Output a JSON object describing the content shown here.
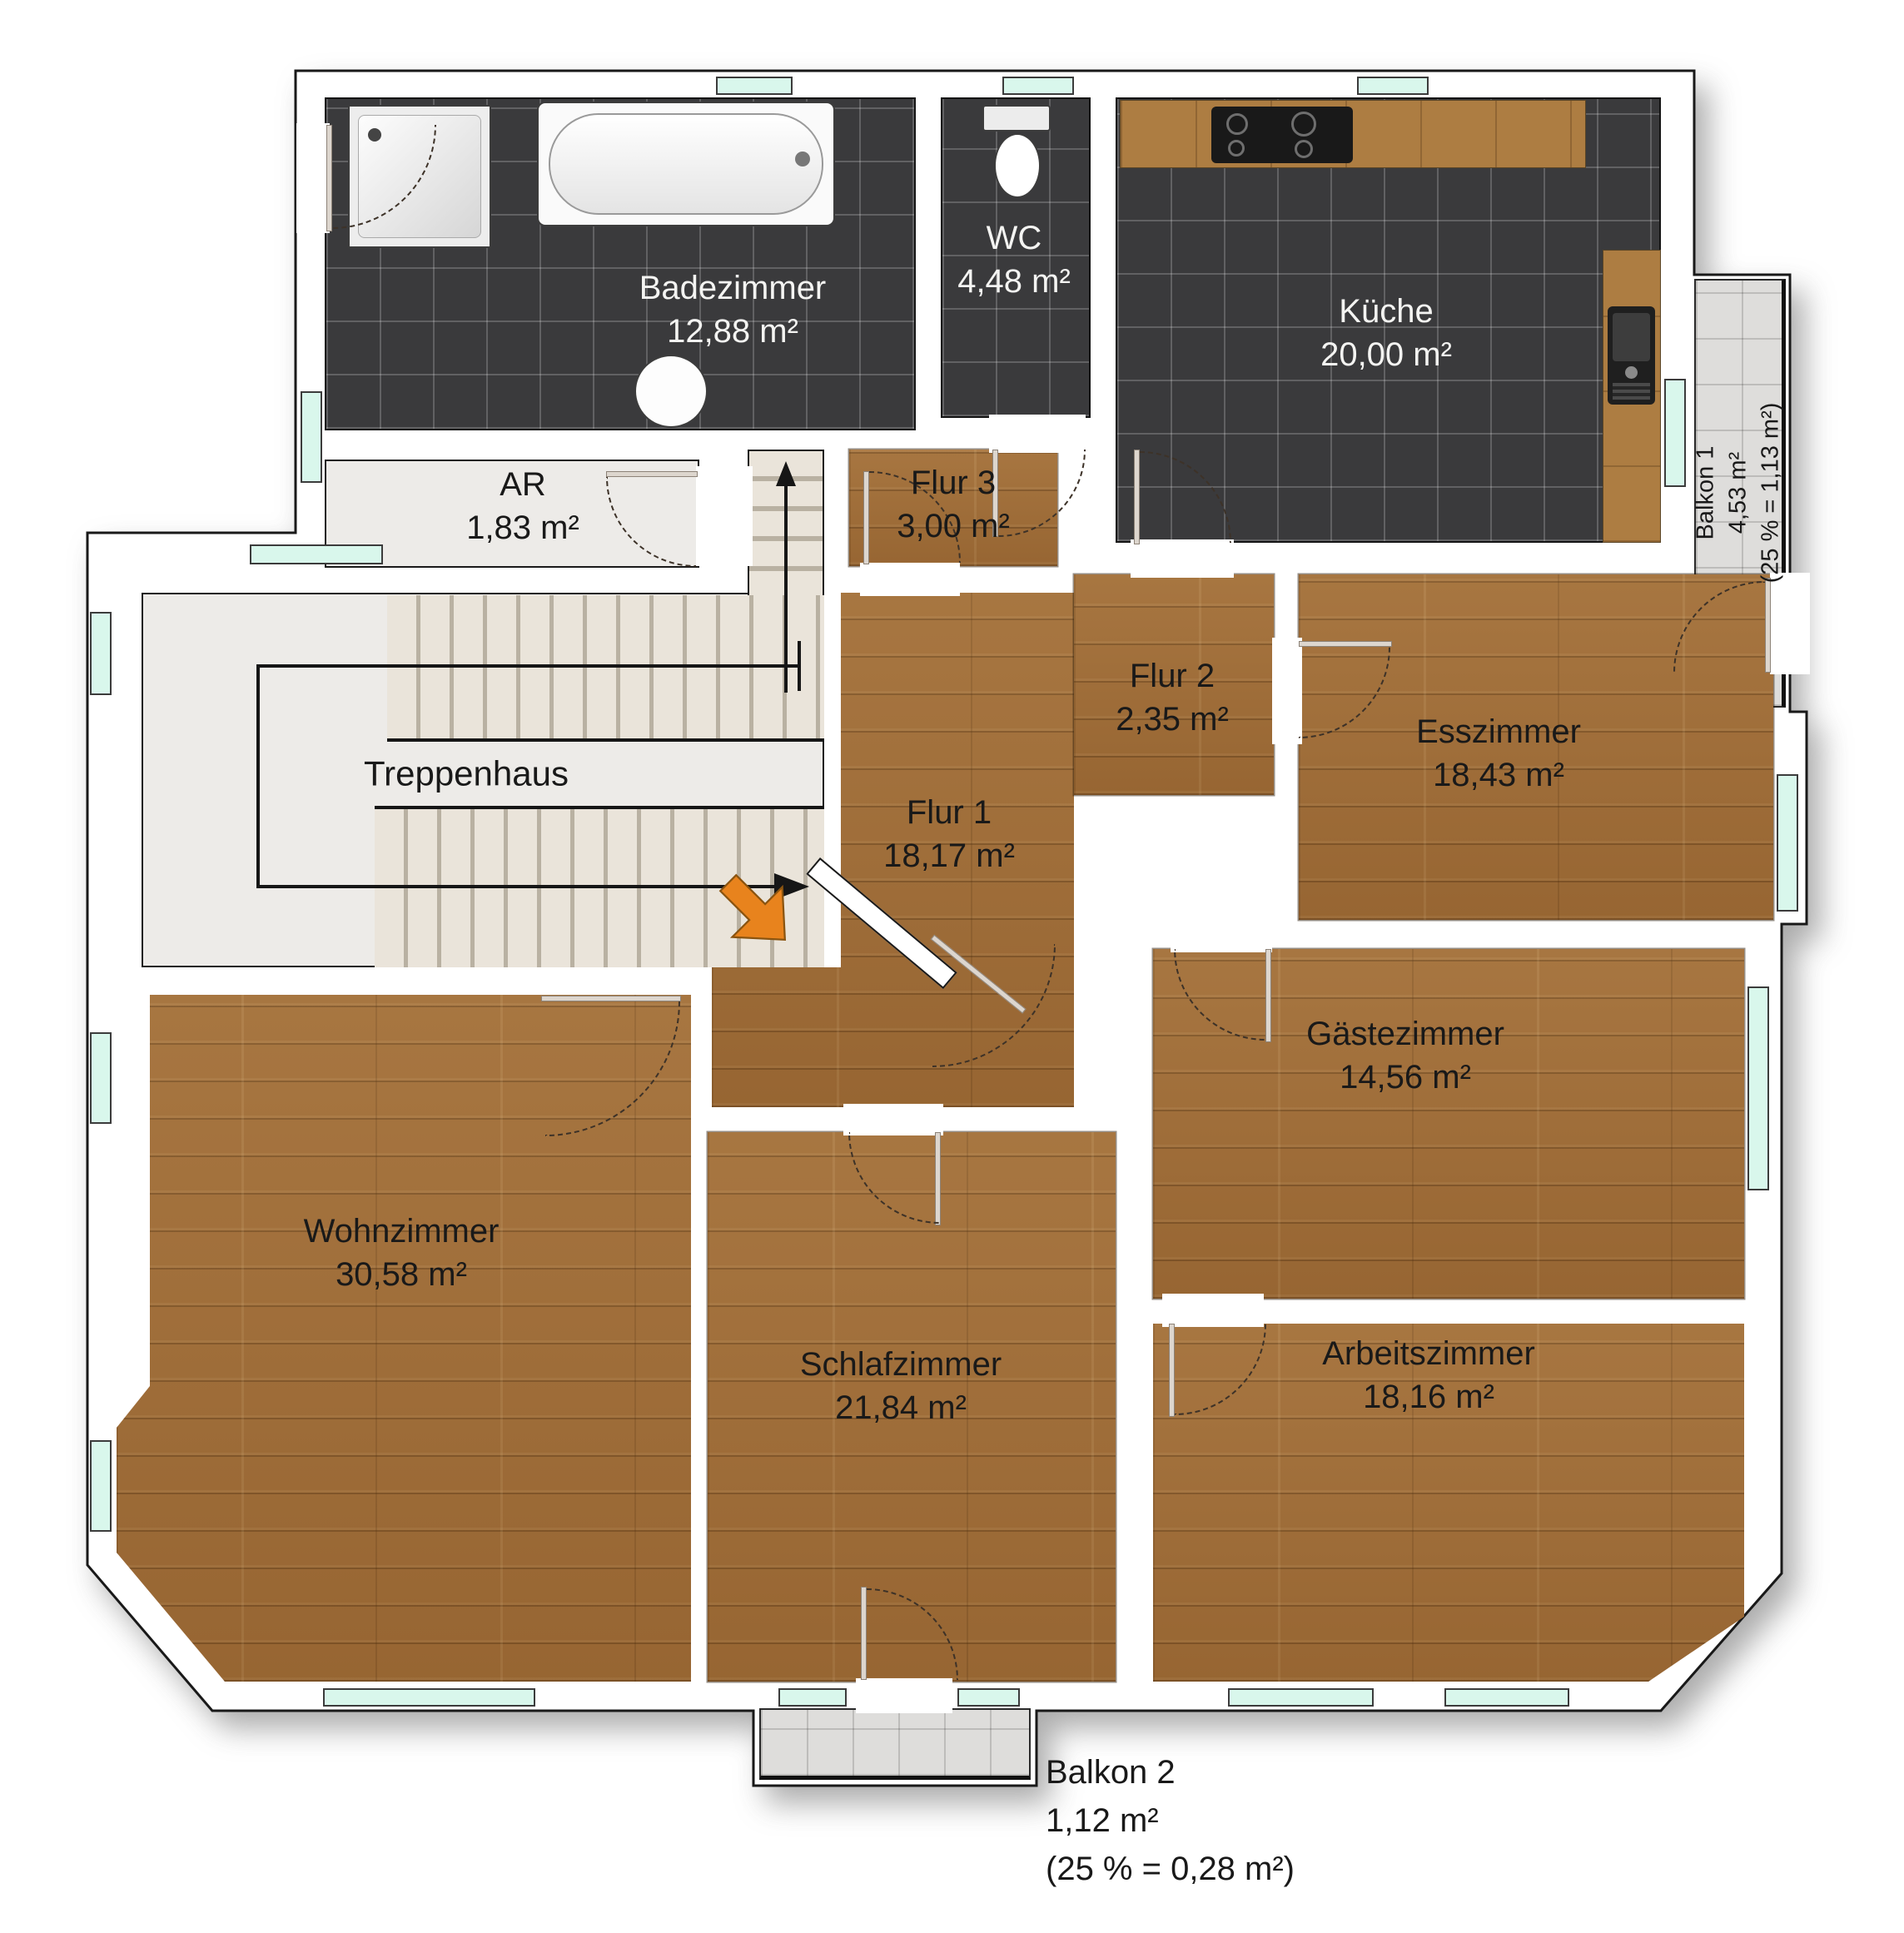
{
  "rooms": {
    "badezimmer": {
      "name": "Badezimmer",
      "area": "12,88 m²"
    },
    "wc": {
      "name": "WC",
      "area": "4,48 m²"
    },
    "kueche": {
      "name": "Küche",
      "area": "20,00 m²"
    },
    "balkon1": {
      "name": "Balkon 1",
      "area": "4,53 m²",
      "note": "(25 % = 1,13 m²)"
    },
    "ar": {
      "name": "AR",
      "area": "1,83 m²"
    },
    "flur3": {
      "name": "Flur 3",
      "area": "3,00 m²"
    },
    "treppenhaus": {
      "name": "Treppenhaus"
    },
    "flur2": {
      "name": "Flur 2",
      "area": "2,35 m²"
    },
    "flur1": {
      "name": "Flur 1",
      "area": "18,17 m²"
    },
    "esszimmer": {
      "name": "Esszimmer",
      "area": "18,43 m²"
    },
    "gaestezimmer": {
      "name": "Gästezimmer",
      "area": "14,56 m²"
    },
    "wohnzimmer": {
      "name": "Wohnzimmer",
      "area": "30,58 m²"
    },
    "schlafzimmer": {
      "name": "Schlafzimmer",
      "area": "21,84 m²"
    },
    "arbeitszimmer": {
      "name": "Arbeitszimmer",
      "area": "18,16 m²"
    },
    "balkon2": {
      "name": "Balkon 2",
      "area": "1,12 m²",
      "note": "(25 % = 0,28 m²)"
    }
  },
  "colors": {
    "wood": "#a06d38",
    "dark_tile": "#3a3a3c",
    "balcony_tile": "#dedddb",
    "stair_floor": "#edebe8",
    "window": "#d9f7ec",
    "entrance_arrow": "#e8831d",
    "wall": "#ffffff",
    "outline": "#1a1a1a"
  }
}
